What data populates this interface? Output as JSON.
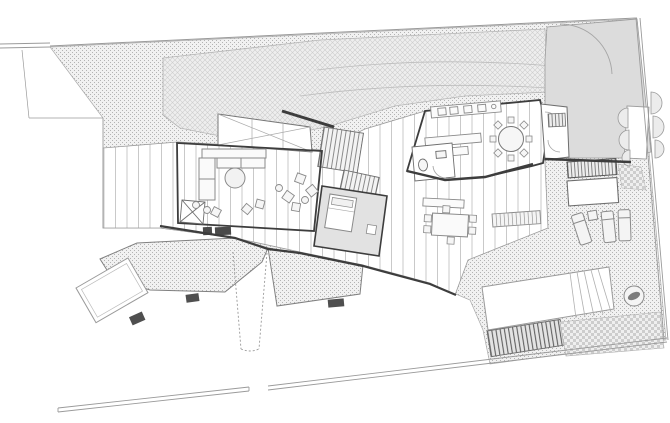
{
  "drawing": {
    "kind": "architectural-site-plan",
    "level": "ground-floor",
    "palette": {
      "paper": "#ffffff",
      "ink": "#3d3d3d",
      "ink_mid": "#6e6e6e",
      "ink_light": "#9a9a9a",
      "terrain_fill": "#f1f1f1",
      "terrain_dot": "#b3b3b3",
      "slope_fill": "#eeeeee",
      "slope_line": "#cdcdcd",
      "court_fill": "#dcdcdc",
      "room_gray": "#e2e2e2",
      "plank_line": "#c9c9c9",
      "stair_line": "#7a7a7a",
      "step_dark": "#4f4f4f",
      "checker": "#cdcdcd",
      "water_feature": "#7d7d7d",
      "furniture_stroke": "#8a8a8a",
      "furniture_fill": "#f6f6f6"
    },
    "features": {
      "site_boundary_walls": 4,
      "hillside_band": 1,
      "entry_courtyard": 1,
      "living_room_sofa": 1,
      "coffee_table": 1,
      "scatter_chairs": 9,
      "round_dining_seats": 8,
      "study_table_seats": 6,
      "staircases": 2,
      "bedroom_beds": 1,
      "sun_loungers": 3,
      "pool": 1,
      "garden_terraces": 3,
      "garden_steps": 3,
      "shrub_scallops": 6
    }
  }
}
